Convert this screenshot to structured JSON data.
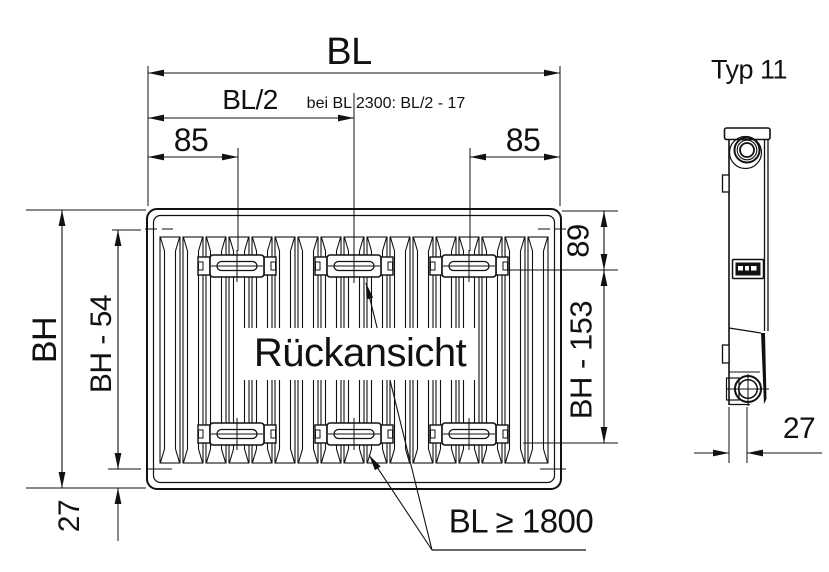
{
  "front_view": {
    "view_label": "Rückansicht",
    "dimensions": {
      "overall_length": "BL",
      "half_length": "BL/2",
      "half_length_note": "bei BL 2300: BL/2 - 17",
      "bracket_offset_left": "85",
      "bracket_offset_right": "85",
      "overall_height": "BH",
      "inner_height": "BH - 54",
      "top_to_bracket": "89",
      "bracket_span": "BH - 153",
      "bottom_offset": "27",
      "middle_bracket_note": "BL ≥ 1800"
    }
  },
  "side_view": {
    "type_label": "Typ 11",
    "depth": "27"
  },
  "colors": {
    "line": "#111111",
    "background": "#ffffff"
  }
}
